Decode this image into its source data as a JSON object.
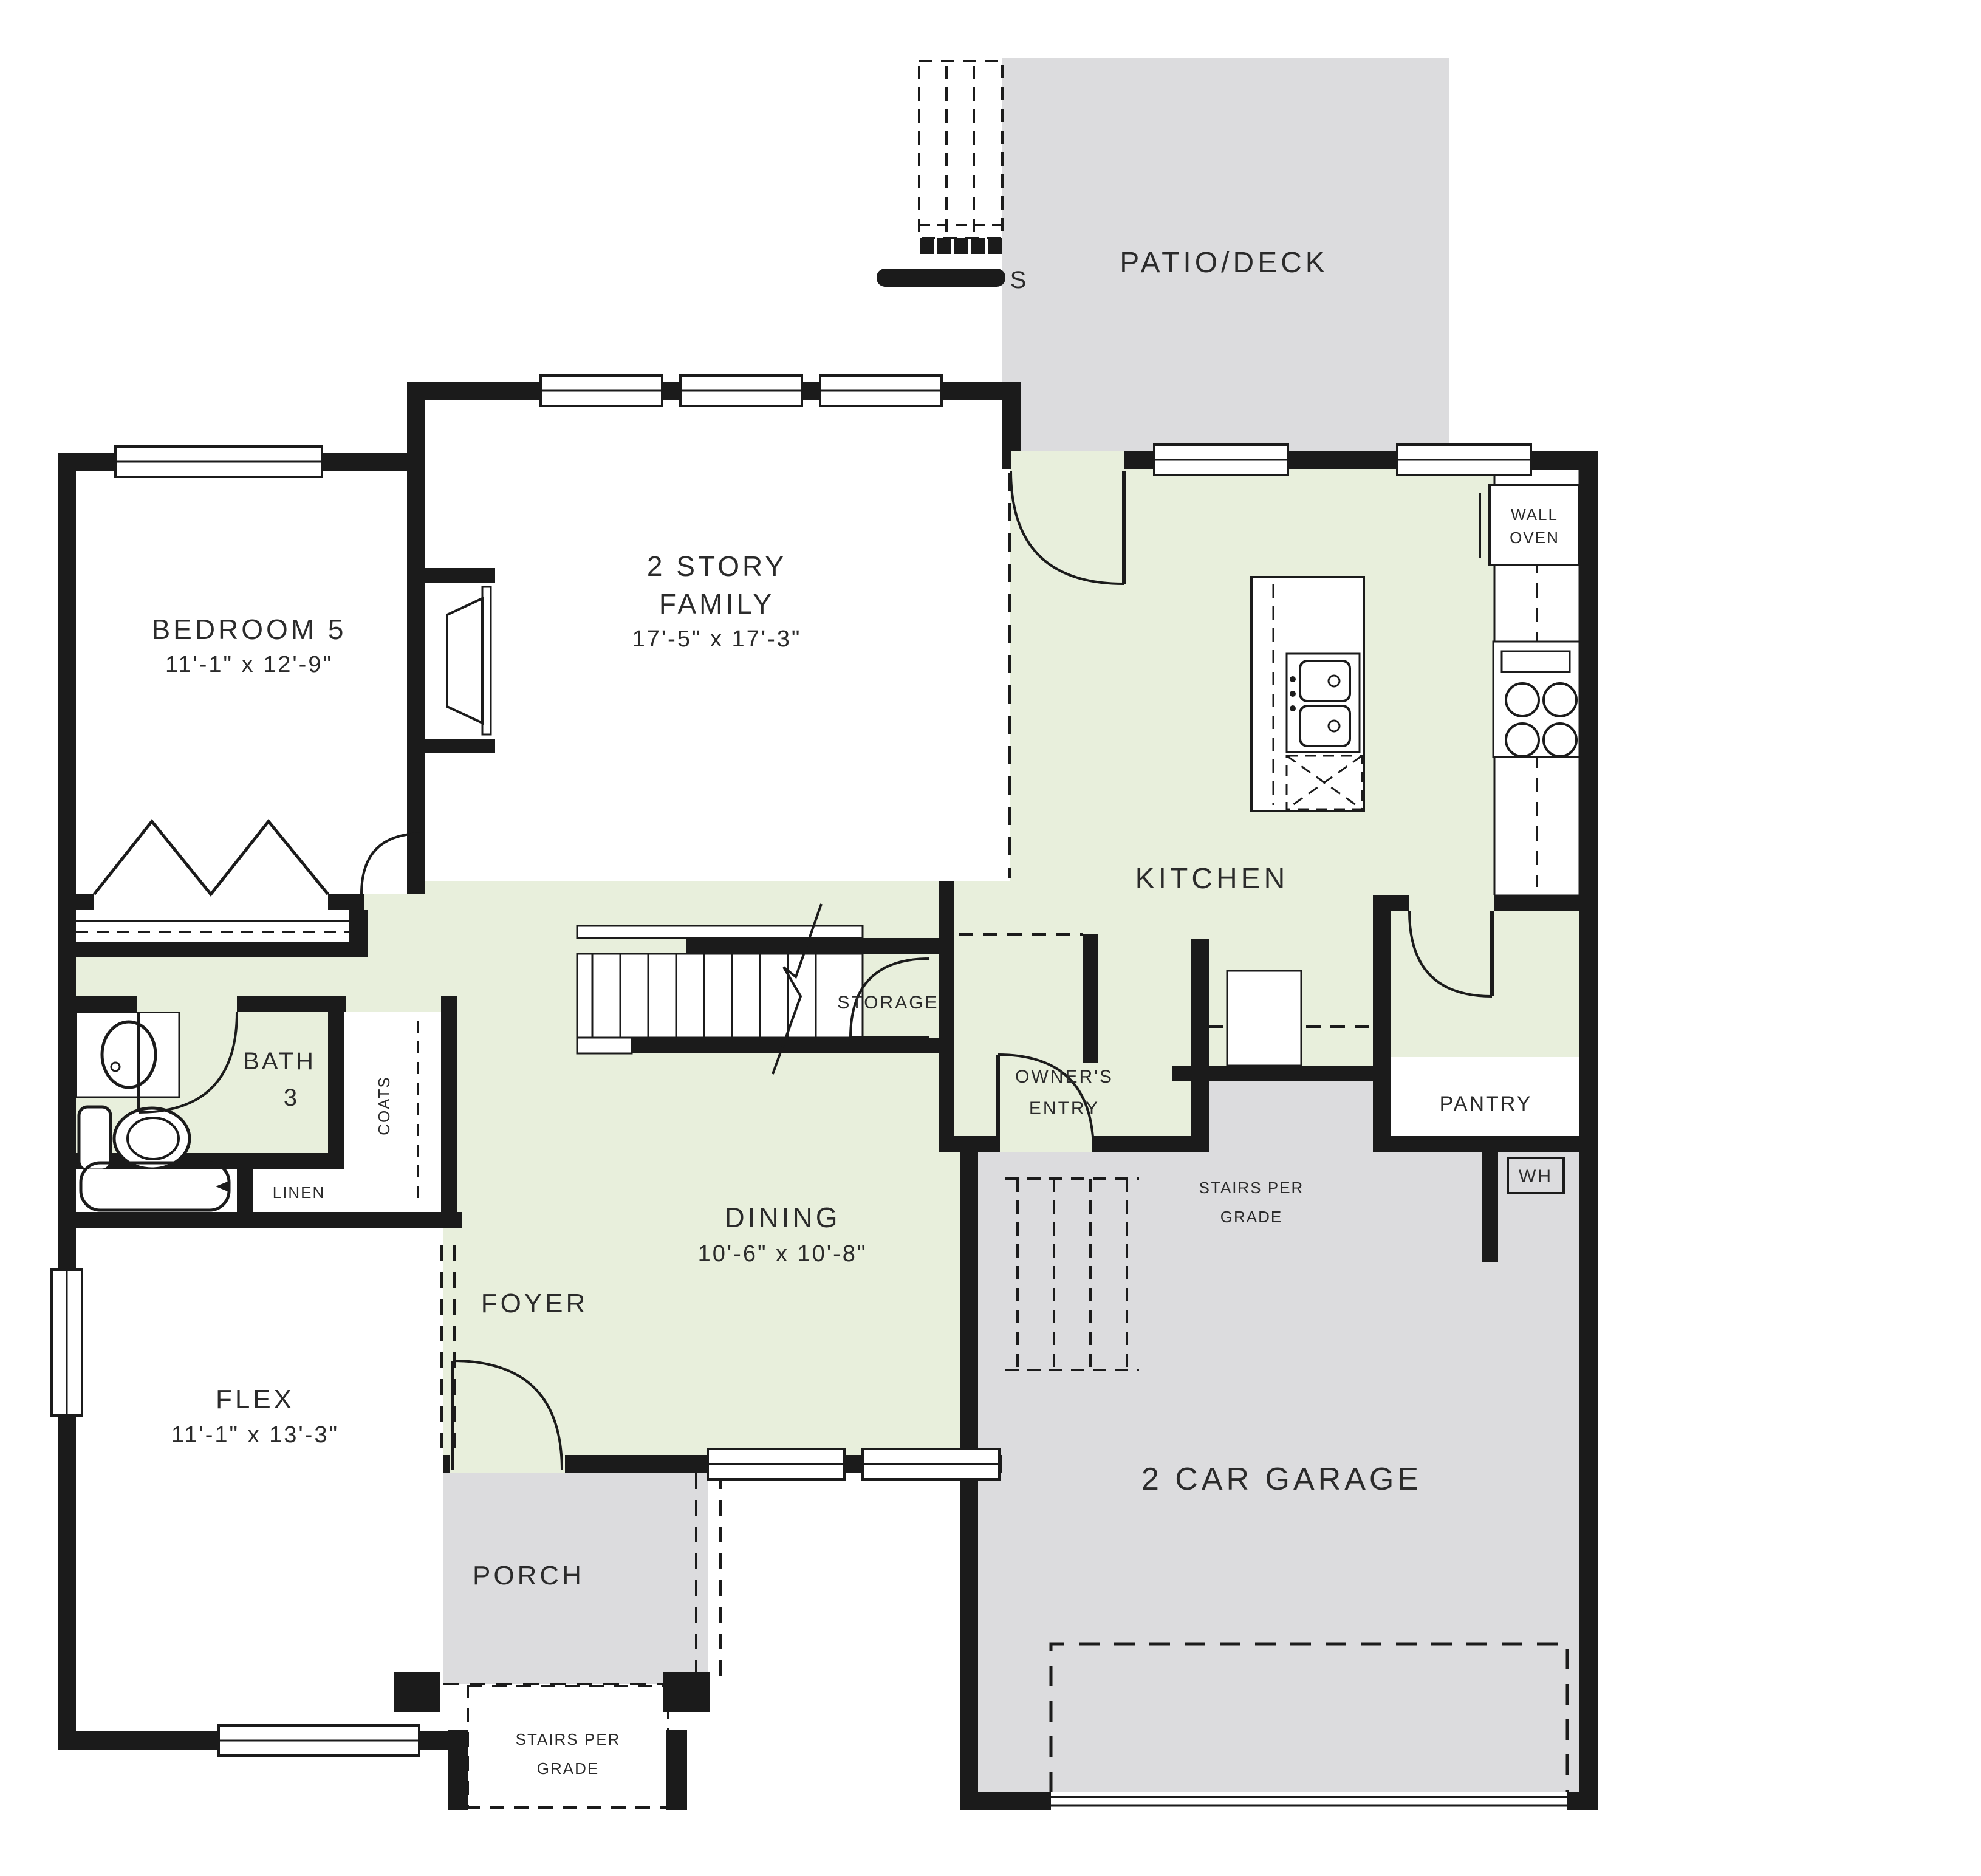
{
  "plan": {
    "colors": {
      "floor_green": "#e8efdc",
      "floor_gray": "#dcdcde",
      "stoop_gray": "#e4e4e6",
      "fixture_blue": "#b7c9dc",
      "wall_black": "#1b1b1b"
    },
    "rooms": {
      "patio": {
        "label": "PATIO/DECK"
      },
      "deck_stairs": {
        "label_end": "S"
      },
      "family": {
        "line1": "2 STORY",
        "line2": "FAMILY",
        "dims": "17'-5\" x 17'-3\""
      },
      "bedroom5": {
        "label": "BEDROOM 5",
        "dims": "11'-1\" x 12'-9\""
      },
      "kitchen": {
        "label": "KITCHEN"
      },
      "wall_oven": {
        "line1": "WALL",
        "line2": "OVEN"
      },
      "bath3": {
        "line1": "BATH",
        "line2": "3"
      },
      "linen": {
        "label": "LINEN"
      },
      "coats": {
        "label": "COATS"
      },
      "storage": {
        "label": "STORAGE"
      },
      "owners_entry": {
        "line1": "OWNER'S",
        "line2": "ENTRY"
      },
      "pantry": {
        "label": "PANTRY"
      },
      "wh": {
        "label": "WH"
      },
      "garage_stairs": {
        "line1": "STAIRS PER",
        "line2": "GRADE"
      },
      "dining": {
        "label": "DINING",
        "dims": "10'-6\" x 10'-8\""
      },
      "foyer": {
        "label": "FOYER"
      },
      "flex": {
        "label": "FLEX",
        "dims": "11'-1\" x 13'-3\""
      },
      "porch": {
        "label": "PORCH"
      },
      "porch_stairs": {
        "line1": "STAIRS PER",
        "line2": "GRADE"
      },
      "garage": {
        "label": "2 CAR GARAGE"
      }
    }
  }
}
